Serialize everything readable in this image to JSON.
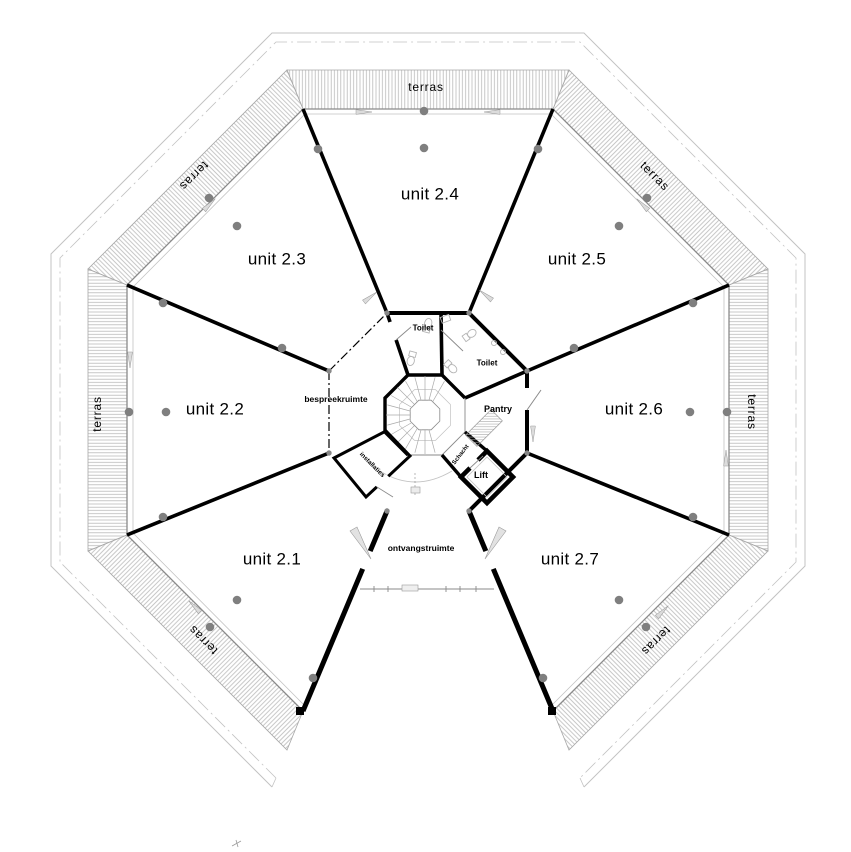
{
  "plan": {
    "type": "architectural-floor-plan",
    "language": "Dutch",
    "units": [
      {
        "label": "unit 2.1"
      },
      {
        "label": "unit 2.2"
      },
      {
        "label": "unit 2.3"
      },
      {
        "label": "unit 2.4"
      },
      {
        "label": "unit 2.5"
      },
      {
        "label": "unit 2.6"
      },
      {
        "label": "unit 2.7"
      }
    ],
    "terraces": [
      {
        "label": "terras",
        "position": "top"
      },
      {
        "label": "terras",
        "position": "upper-left"
      },
      {
        "label": "terras",
        "position": "upper-right"
      },
      {
        "label": "terras",
        "position": "left"
      },
      {
        "label": "terras",
        "position": "right"
      },
      {
        "label": "terras",
        "position": "lower-left"
      },
      {
        "label": "terras",
        "position": "lower-right"
      }
    ],
    "core_rooms": [
      {
        "label": "Toilet"
      },
      {
        "label": "Toilet"
      },
      {
        "label": "Pantry"
      },
      {
        "label": "Lift"
      },
      {
        "label": "Schacht"
      },
      {
        "label": "installaties"
      },
      {
        "label": "bespreekruimte"
      },
      {
        "label": "ontvangstruimte"
      }
    ],
    "colors": {
      "walls": "#000000",
      "outline": "#9a9a9a",
      "hatch": "#b9b9b9",
      "columns": "#7f7f7f",
      "text": "#000000",
      "background": "#ffffff"
    }
  }
}
